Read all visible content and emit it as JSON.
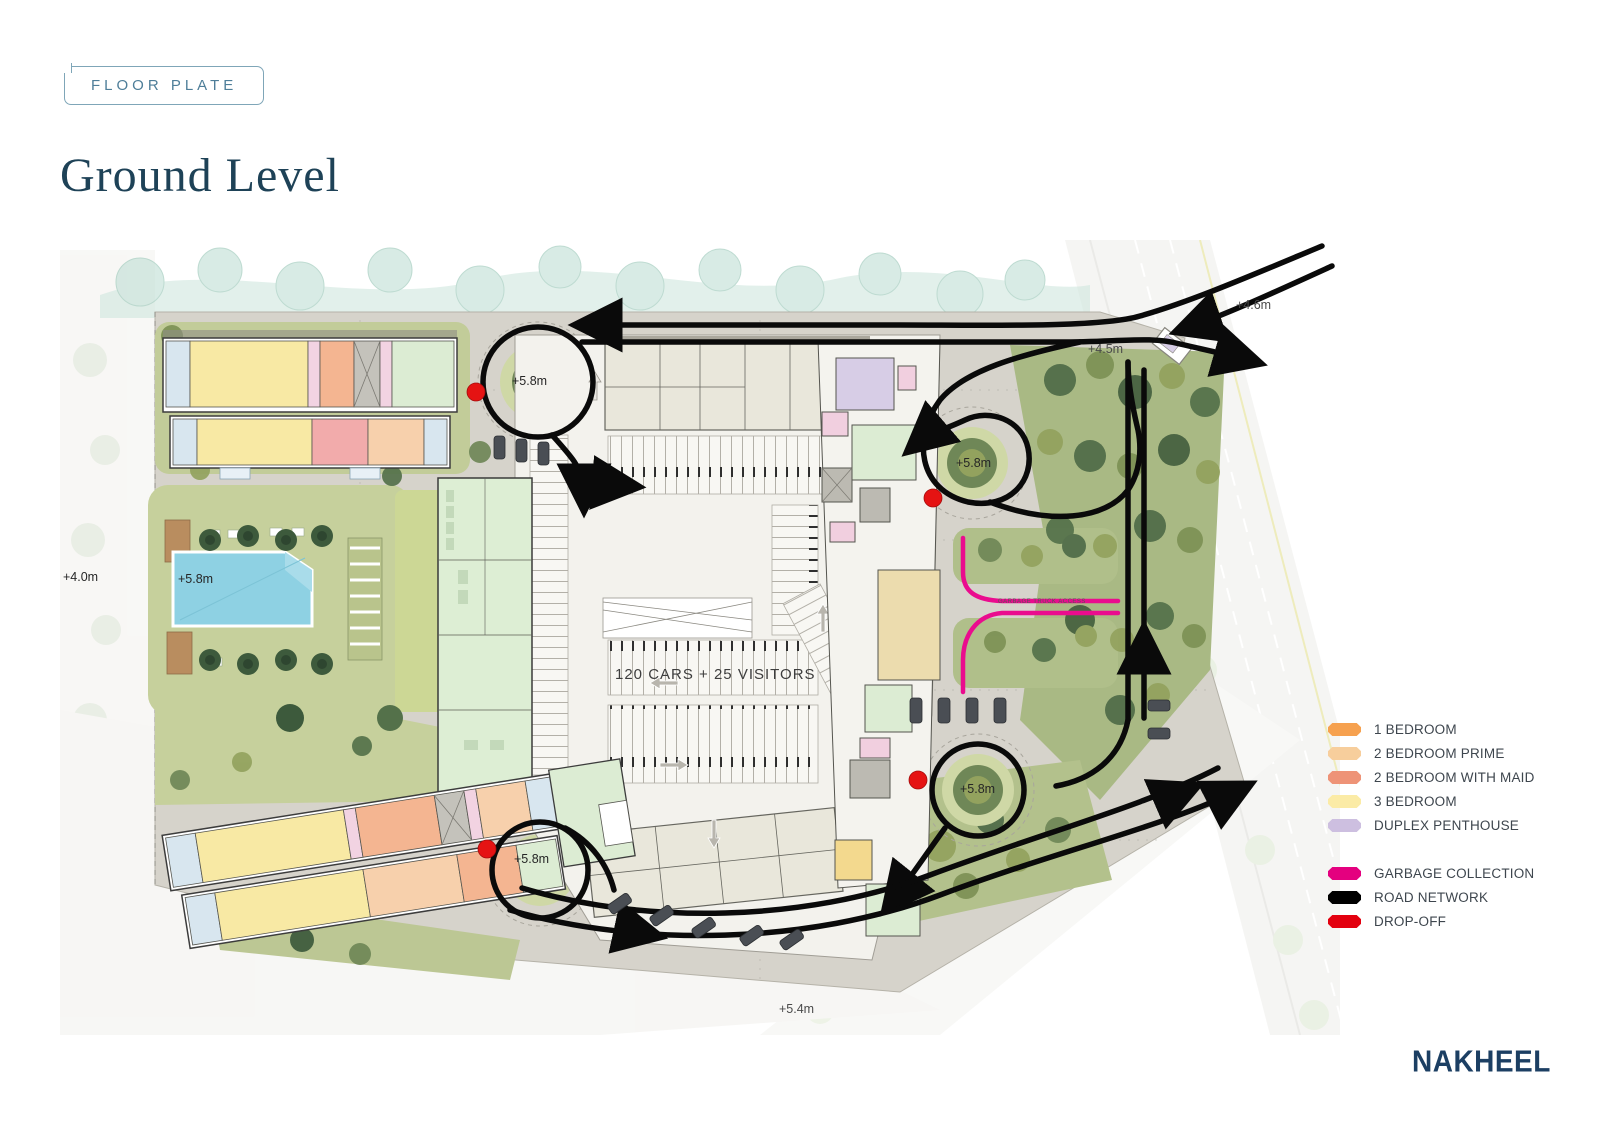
{
  "header": {
    "badge": "FLOOR PLATE",
    "title": "Ground Level"
  },
  "plan": {
    "parking_note": "120 CARS + 25 VISITORS",
    "garbage_route_label": "GARBAGE TRUCK ACCESS",
    "labels": {
      "elev_west": "+4.0m",
      "elev_highway": "+4.6m",
      "elev_junction": "+4.5m",
      "elev_south": "+5.4m",
      "pool": "+5.8m",
      "roundabout_nw": "+5.8m",
      "roundabout_mid": "+5.8m",
      "roundabout_se": "+5.8m",
      "roundabout_sw": "+5.8m"
    }
  },
  "legend": {
    "units": [
      {
        "label": "1 BEDROOM",
        "color": "#F6A14F"
      },
      {
        "label": "2 BEDROOM PRIME",
        "color": "#F7CE9C"
      },
      {
        "label": "2 BEDROOM WITH MAID",
        "color": "#EE9377"
      },
      {
        "label": "3 BEDROOM",
        "color": "#FBEBA6"
      },
      {
        "label": "DUPLEX PENTHOUSE",
        "color": "#CDBFE0"
      }
    ],
    "routes": [
      {
        "label": "GARBAGE COLLECTION",
        "color": "#E4007F"
      },
      {
        "label": "ROAD NETWORK",
        "color": "#000000"
      },
      {
        "label": "DROP-OFF",
        "color": "#E3000F"
      }
    ]
  },
  "footer": {
    "brand": "NAKHEEL"
  }
}
